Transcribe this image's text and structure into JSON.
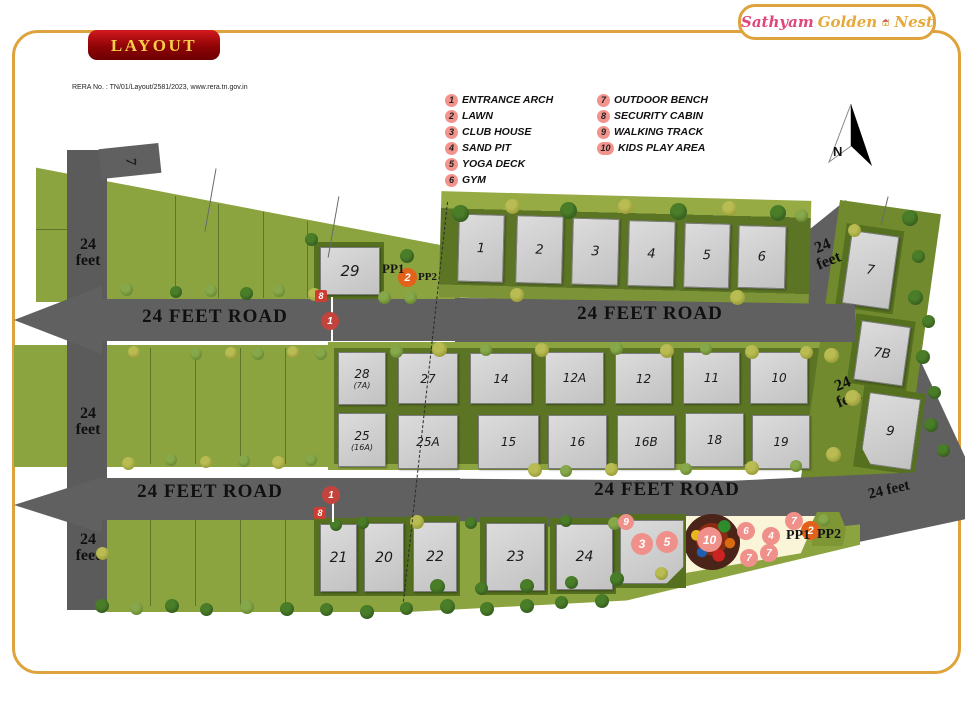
{
  "brand": {
    "sathyam": "Sathyam",
    "golden": "Golden",
    "nest": "Nest"
  },
  "header": {
    "badge": "LAYOUT",
    "rera": "RERA No. : TN/01/Layout/2581/2023, www.rera.tn.gov.in"
  },
  "compass": {
    "label": "N"
  },
  "legend": {
    "left": [
      {
        "num": "1",
        "label": "ENTRANCE ARCH"
      },
      {
        "num": "2",
        "label": "LAWN"
      },
      {
        "num": "3",
        "label": "CLUB HOUSE"
      },
      {
        "num": "4",
        "label": "SAND PIT"
      },
      {
        "num": "5",
        "label": "YOGA DECK"
      },
      {
        "num": "6",
        "label": "GYM"
      }
    ],
    "right": [
      {
        "num": "7",
        "label": "OUTDOOR BENCH"
      },
      {
        "num": "8",
        "label": "SECURITY CABIN"
      },
      {
        "num": "9",
        "label": "WALKING TRACK"
      },
      {
        "num": "10",
        "label": "KIDS PLAY AREA"
      }
    ]
  },
  "roads": {
    "road_label": "24 FEET ROAD",
    "feet_label": "24 feet"
  },
  "plots": {
    "p1": "1",
    "p2": "2",
    "p3": "3",
    "p4": "4",
    "p5": "5",
    "p6": "6",
    "p7": "7",
    "p7b": "7B",
    "p9": "9",
    "p28": "28",
    "p28_sub": "(7A)",
    "p27": "27",
    "p14": "14",
    "p12a": "12A",
    "p12": "12",
    "p11": "11",
    "p10": "10",
    "p25": "25",
    "p25_sub": "(16A)",
    "p25a": "25A",
    "p15": "15",
    "p16": "16",
    "p16b": "16B",
    "p18": "18",
    "p19": "19",
    "p21": "21",
    "p20": "20",
    "p22": "22",
    "p23": "23",
    "p24": "24",
    "p29": "29",
    "stub": "7"
  },
  "markers": {
    "m1": "1",
    "m2": "2",
    "m3": "3",
    "m4": "4",
    "m5": "5",
    "m6": "6",
    "m7": "7",
    "m8": "8",
    "m9": "9",
    "m10": "10",
    "pp1": "PP1",
    "pp2": "PP2"
  },
  "colors": {
    "frame_gold": "#DFA33D",
    "badge_red": "#9A0B0F",
    "badge_text": "#F7D04A",
    "logo_pink": "#E0457B",
    "logo_gold": "#E6A93C",
    "road_gray": "#606060",
    "green_light": "#8CA43F",
    "green_dark": "#5C7525",
    "plot_gray": "#CDCDCD",
    "legend_pink": "#F2938C",
    "marker_red": "#C2443C",
    "marker_orange": "#E2611B",
    "cream": "#FAF5D8"
  }
}
